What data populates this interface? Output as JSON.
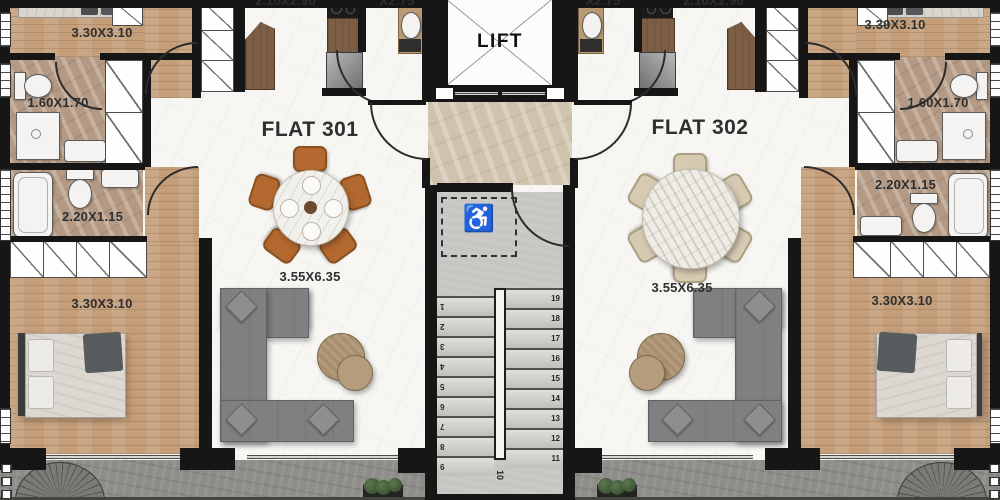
{
  "lift": {
    "label": "LIFT"
  },
  "flats": {
    "left": {
      "name": "FLAT 301",
      "kitchen_dim": "2.10X2.90",
      "utility_dim": "X2.75",
      "bedroom_top_dim": "3.30X3.10",
      "bathroom_top_dim": "1.60X1.70",
      "bathroom_mid_dim": "2.20X1.15",
      "living_dim": "3.55X6.35",
      "bedroom_bottom_dim": "3.30X3.10"
    },
    "right": {
      "name": "FLAT 302",
      "kitchen_dim": "2.10X2.90",
      "utility_dim": "X2.75",
      "bedroom_top_dim": "3.30X3.10",
      "bathroom_top_dim": "1.60X1.70",
      "bathroom_mid_dim": "2.20X1.15",
      "living_dim": "3.55X6.35",
      "bedroom_bottom_dim": "3.30X3.10"
    }
  },
  "stairs": {
    "up_flight_numbers": [
      "1",
      "2",
      "3",
      "4",
      "5",
      "6",
      "7",
      "8",
      "9"
    ],
    "landing_number": "10",
    "down_flight_numbers": [
      "19",
      "18",
      "17",
      "16",
      "15",
      "14",
      "13",
      "12",
      "11"
    ],
    "accessibility_icon": "♿"
  },
  "colors": {
    "wall": "#161616",
    "wood_floor": "#c49e79",
    "bath_marble": "#b49a85",
    "hall_marble": "#cfc3ad",
    "living_marble": "#f6f5f2",
    "stair_concrete": "#c7c6c2",
    "balcony_stone": "#8e8d89",
    "sofa": "#7f8082",
    "dining_chair_left": "#b2682f",
    "dining_chair_right": "#d6cbb2",
    "label_text": "#2f2f2f"
  }
}
